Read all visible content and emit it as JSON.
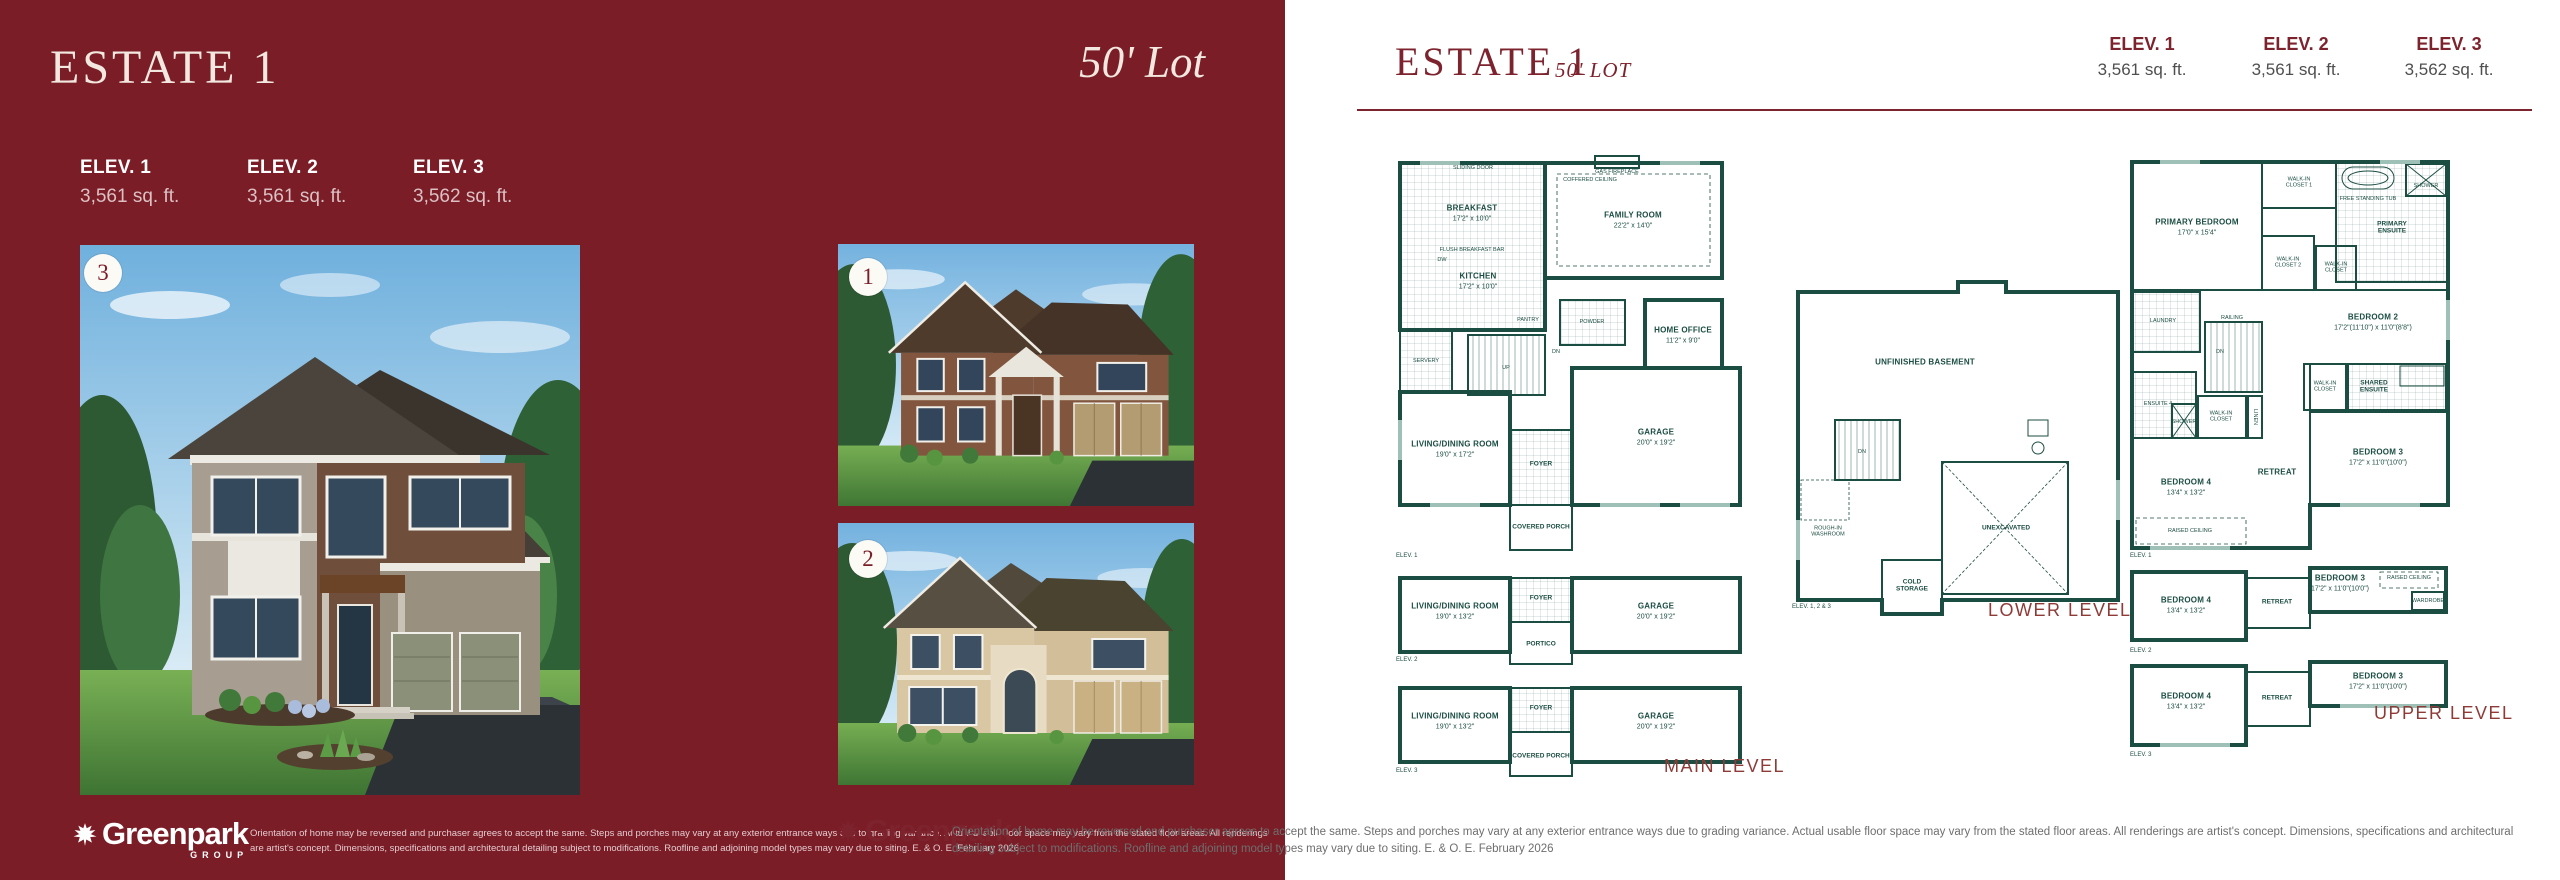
{
  "left_panel": {
    "title": "ESTATE 1",
    "lot": "50' Lot",
    "elevations": [
      {
        "label": "ELEV. 1",
        "area": "3,561 sq. ft."
      },
      {
        "label": "ELEV. 2",
        "area": "3,561 sq. ft."
      },
      {
        "label": "ELEV. 3",
        "area": "3,562 sq. ft."
      }
    ],
    "badges": {
      "main": "3",
      "top": "1",
      "bottom": "2"
    }
  },
  "right_panel": {
    "title": "ESTATE 1",
    "lot": "50' LOT",
    "elevations": [
      {
        "label": "ELEV. 1",
        "area": "3,561 sq. ft."
      },
      {
        "label": "ELEV. 2",
        "area": "3,561 sq. ft."
      },
      {
        "label": "ELEV. 3",
        "area": "3,562 sq. ft."
      }
    ]
  },
  "plans": {
    "main": {
      "level_label": "MAIN LEVEL",
      "elev1_tag": "ELEV. 1",
      "elev2_tag": "ELEV. 2",
      "elev3_tag": "ELEV. 3",
      "sliding_door": "SLIDING DOOR",
      "gas_fireplace": "GAS FIREPLACE",
      "coffered_ceiling": "COFFERED CEILING",
      "breakfast": "BREAKFAST",
      "breakfast_dim": "17'2\" x 10'0\"",
      "family_room": "FAMILY ROOM",
      "family_room_dim": "22'2\" x 14'0\"",
      "kitchen": "KITCHEN",
      "kitchen_dim": "17'2\" x 10'0\"",
      "flush_bar": "FLUSH BREAKFAST BAR",
      "dw": "DW",
      "pantry": "PANTRY",
      "servery": "SERVERY",
      "home_office": "HOME OFFICE",
      "home_office_dim": "11'2\" x 9'0\"",
      "powder": "POWDER",
      "up": "UP",
      "dn": "DN",
      "living_dining": "LIVING/DINING ROOM",
      "living_dining_dim": "19'0\" x 17'2\"",
      "living_dining_dim_alt": "19'0\" x 13'2\"",
      "foyer": "FOYER",
      "garage": "GARAGE",
      "garage_dim": "20'0\" x 19'2\"",
      "covered_porch": "COVERED PORCH",
      "portico": "PORTICO"
    },
    "lower": {
      "level_label": "LOWER LEVEL",
      "elev_tag": "ELEV. 1, 2 & 3",
      "unfinished_basement": "UNFINISHED BASEMENT",
      "rough_in": "ROUGH-IN WASHROOM",
      "cold_storage": "COLD STORAGE",
      "unexcavated": "UNEXCAVATED",
      "dn": "DN"
    },
    "upper": {
      "level_label": "UPPER LEVEL",
      "elev1_tag": "ELEV. 1",
      "elev2_tag": "ELEV. 2",
      "elev3_tag": "ELEV. 3",
      "primary_bedroom": "PRIMARY BEDROOM",
      "primary_bedroom_dim": "17'0\" x 15'4\"",
      "wic1": "WALK-IN CLOSET 1",
      "wic2": "WALK-IN CLOSET 2",
      "wic": "WALK-IN CLOSET",
      "free_tub": "FREE STANDING TUB",
      "shower": "SHOWER",
      "primary_ensuite": "PRIMARY ENSUITE",
      "bedroom2": "BEDROOM 2",
      "bedroom2_dim": "17'2\"(11'10\") x 11'0\"(8'8\")",
      "laundry": "LAUNDRY",
      "railing": "RAILING",
      "dn": "DN",
      "ensuite4": "ENSUITE 4",
      "linen": "LINEN",
      "shared_ensuite": "SHARED ENSUITE",
      "retreat": "RETREAT",
      "bedroom4": "BEDROOM 4",
      "bedroom4_dim": "13'4\" x 13'2\"",
      "bedroom3": "BEDROOM 3",
      "bedroom3_dim": "17'2\" x 11'0\"(10'0\")",
      "raised_ceiling": "RAISED CEILING",
      "wardrobe": "WARDROBE"
    }
  },
  "footer": {
    "brand": "Greenpark",
    "brand_sub": "GROUP",
    "disclaimer": "Orientation of home may be reversed and purchaser agrees to accept the same. Steps and porches may vary at any exterior entrance ways due to grading variance. Actual usable floor space may vary from the stated floor areas. All renderings are artist's concept. Dimensions, specifications and architectural detailing subject to modifications. Roofline and adjoining model types may vary due to siting. E. & O. E. February 2026"
  },
  "colors": {
    "maroon_background": "#7a1d27",
    "maroon_text": "#7d232e",
    "plan_walls": "#1b4d42",
    "level_label_text": "#8e3b38"
  }
}
